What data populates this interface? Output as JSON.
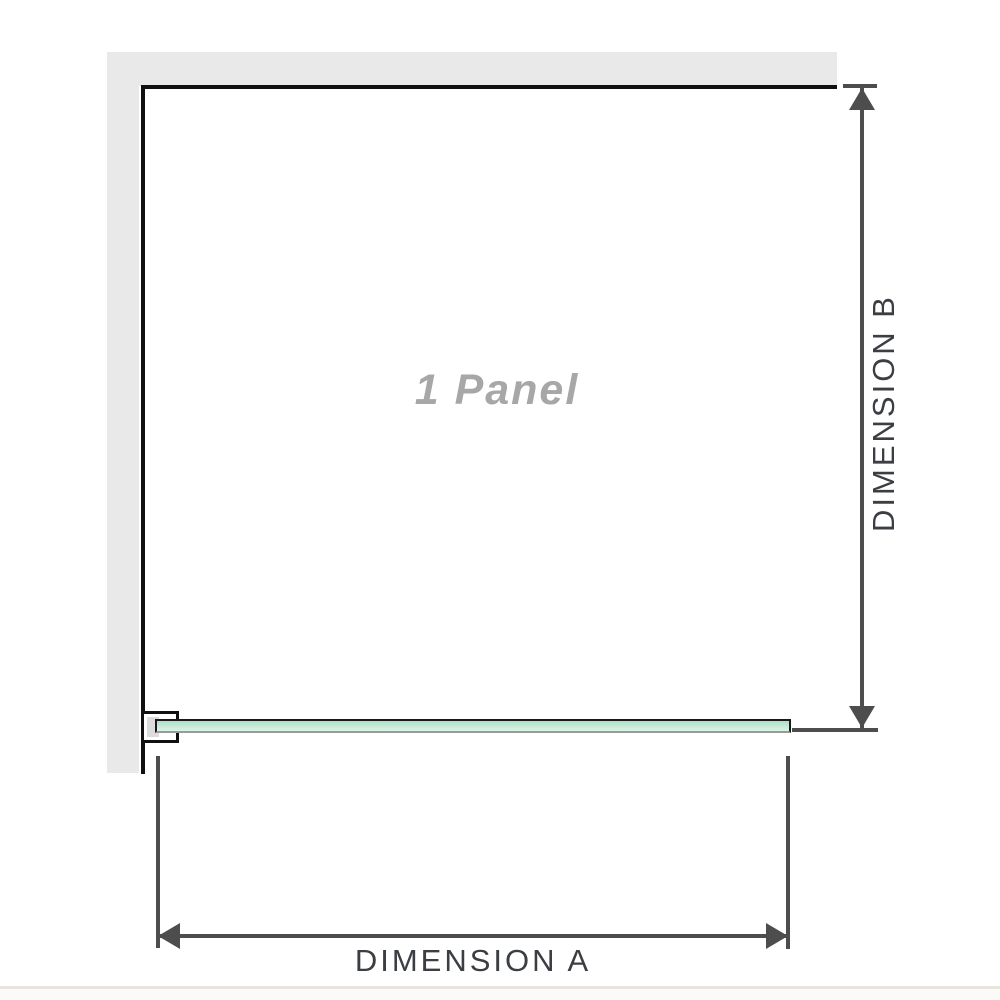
{
  "diagram": {
    "panel_label": "1 Panel",
    "dimensions": {
      "a_label": "DIMENSION A",
      "b_label": "DIMENSION B"
    }
  },
  "colors": {
    "wall": "#e9e9e9",
    "wall_edge": "#101010",
    "glass_fill_top": "#abe1c4",
    "glass_fill_bottom": "#ddf3e8",
    "glass_border": "#1a1a1a",
    "bracket_fill": "#dcdcdc",
    "dimension_line": "#4d4d4d",
    "dimension_text": "#3b3e42",
    "panel_text": "#a7a7a7",
    "footer_line": "#e8e5df"
  }
}
